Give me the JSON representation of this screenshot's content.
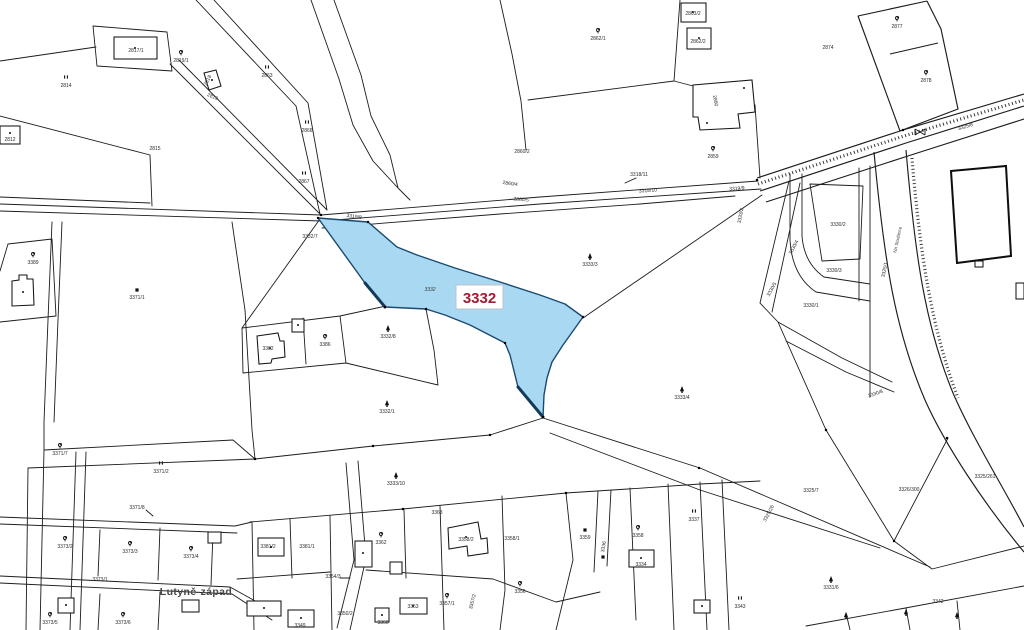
{
  "map": {
    "type": "cadastral-parcel-map",
    "colors": {
      "background": "#ffffff",
      "boundary": "#1c1c1c",
      "highlight_fill": "#a9d8f2",
      "highlight_border": "#1b4a70",
      "highlight_label_text": "#9f1d33",
      "label_text": "#2b2b2b",
      "place_text": "#474747"
    },
    "highlight": {
      "parcel_number": "3332",
      "box_label": "3332",
      "inline_label": "3332"
    },
    "place_name": {
      "text": "Lutyně-západ"
    },
    "parcel_labels": [
      {
        "t": "2817/1",
        "x": 136,
        "y": 52
      },
      {
        "t": "2819/1",
        "x": 181,
        "y": 62,
        "icon": "deciduous"
      },
      {
        "t": "2814",
        "x": 66,
        "y": 87,
        "icon": "meadow"
      },
      {
        "t": "2812",
        "x": 10,
        "y": 141
      },
      {
        "t": "2815",
        "x": 155,
        "y": 150
      },
      {
        "t": "2863",
        "x": 267,
        "y": 77,
        "icon": "meadow"
      },
      {
        "t": "2866",
        "x": 307,
        "y": 132,
        "icon": "meadow"
      },
      {
        "t": "2867",
        "x": 304,
        "y": 183,
        "icon": "meadow"
      },
      {
        "t": "2818",
        "x": 209,
        "y": 81,
        "rot": -62
      },
      {
        "t": "2819",
        "x": 212,
        "y": 98,
        "rot": 24
      },
      {
        "t": "2862/1",
        "x": 598,
        "y": 40,
        "icon": "deciduous"
      },
      {
        "t": "2863/2",
        "x": 693,
        "y": 15
      },
      {
        "t": "2862/2",
        "x": 698,
        "y": 43
      },
      {
        "t": "2860",
        "x": 714,
        "y": 101,
        "rot": 80
      },
      {
        "t": "2860/2",
        "x": 522,
        "y": 153
      },
      {
        "t": "2859",
        "x": 713,
        "y": 158,
        "icon": "deciduous"
      },
      {
        "t": "3318/11",
        "x": 639,
        "y": 176
      },
      {
        "t": "2860/4",
        "x": 510,
        "y": 185,
        "rot": 8
      },
      {
        "t": "2860/5",
        "x": 521,
        "y": 201,
        "rot": 5
      },
      {
        "t": "3318/10",
        "x": 648,
        "y": 192,
        "rot": -4
      },
      {
        "t": "3319/9",
        "x": 737,
        "y": 190,
        "rot": -4
      },
      {
        "t": "2874",
        "x": 828,
        "y": 49
      },
      {
        "t": "2877",
        "x": 897,
        "y": 28,
        "icon": "deciduous"
      },
      {
        "t": "2878",
        "x": 926,
        "y": 82,
        "icon": "deciduous"
      },
      {
        "t": "3325/8",
        "x": 966,
        "y": 128,
        "rot": -17
      },
      {
        "t": "3332/7",
        "x": 310,
        "y": 238
      },
      {
        "t": "3319/8",
        "x": 354,
        "y": 218,
        "rot": 8
      },
      {
        "t": "3333/3",
        "x": 590,
        "y": 266,
        "icon": "conifer"
      },
      {
        "t": "3333/4",
        "x": 682,
        "y": 399,
        "icon": "conifer"
      },
      {
        "t": "3332/8",
        "x": 388,
        "y": 338,
        "icon": "conifer"
      },
      {
        "t": "3332/1",
        "x": 387,
        "y": 413,
        "icon": "conifer"
      },
      {
        "t": "3333/10",
        "x": 396,
        "y": 485,
        "icon": "conifer"
      },
      {
        "t": "3386",
        "x": 325,
        "y": 346,
        "icon": "deciduous"
      },
      {
        "t": "3382",
        "x": 268,
        "y": 350
      },
      {
        "t": "3389",
        "x": 33,
        "y": 264,
        "icon": "deciduous"
      },
      {
        "t": "3371/1",
        "x": 137,
        "y": 299,
        "icon": "building-mark"
      },
      {
        "t": "3371/2",
        "x": 161,
        "y": 473,
        "icon": "meadow"
      },
      {
        "t": "3371/7",
        "x": 60,
        "y": 455,
        "icon": "deciduous"
      },
      {
        "t": "3371/8",
        "x": 137,
        "y": 509
      },
      {
        "t": "3373/2",
        "x": 65,
        "y": 548,
        "icon": "deciduous"
      },
      {
        "t": "3373/3",
        "x": 130,
        "y": 553,
        "icon": "deciduous"
      },
      {
        "t": "3373/4",
        "x": 191,
        "y": 558,
        "icon": "deciduous"
      },
      {
        "t": "3373/1",
        "x": 100,
        "y": 581
      },
      {
        "t": "3373/5",
        "x": 50,
        "y": 624,
        "icon": "deciduous"
      },
      {
        "t": "3373/6",
        "x": 123,
        "y": 624,
        "icon": "deciduous"
      },
      {
        "t": "3381/2",
        "x": 268,
        "y": 548
      },
      {
        "t": "3381/1",
        "x": 307,
        "y": 548
      },
      {
        "t": "3362",
        "x": 381,
        "y": 544,
        "icon": "deciduous"
      },
      {
        "t": "3363",
        "x": 437,
        "y": 514
      },
      {
        "t": "3358/2",
        "x": 466,
        "y": 541
      },
      {
        "t": "3358/1",
        "x": 512,
        "y": 540
      },
      {
        "t": "3354/3",
        "x": 333,
        "y": 578
      },
      {
        "t": "3350/2",
        "x": 345,
        "y": 615
      },
      {
        "t": "3349",
        "x": 300,
        "y": 627
      },
      {
        "t": "3360",
        "x": 383,
        "y": 624
      },
      {
        "t": "3353",
        "x": 413,
        "y": 608
      },
      {
        "t": "3357/1",
        "x": 447,
        "y": 605,
        "icon": "deciduous"
      },
      {
        "t": "3357/2",
        "x": 474,
        "y": 602,
        "rot": -75
      },
      {
        "t": "3356",
        "x": 520,
        "y": 593,
        "icon": "deciduous"
      },
      {
        "t": "3359",
        "x": 585,
        "y": 539,
        "icon": "building-mark"
      },
      {
        "t": "3336",
        "x": 605,
        "y": 547,
        "rot": -80
      },
      {
        "t": "3358",
        "x": 638,
        "y": 537,
        "icon": "deciduous"
      },
      {
        "t": "3337",
        "x": 694,
        "y": 521,
        "icon": "meadow"
      },
      {
        "t": "3334",
        "x": 641,
        "y": 566
      },
      {
        "t": "3343",
        "x": 740,
        "y": 608,
        "icon": "meadow"
      },
      {
        "t": "3325/26",
        "x": 770,
        "y": 514,
        "rot": -62
      },
      {
        "t": "3325/7",
        "x": 811,
        "y": 492
      },
      {
        "t": "3326/300",
        "x": 909,
        "y": 491
      },
      {
        "t": "3325/261",
        "x": 985,
        "y": 478
      },
      {
        "t": "3331/6",
        "x": 831,
        "y": 589,
        "icon": "conifer"
      },
      {
        "t": "3342",
        "x": 938,
        "y": 603
      },
      {
        "t": "3330/2",
        "x": 838,
        "y": 226
      },
      {
        "t": "3330/3",
        "x": 834,
        "y": 272
      },
      {
        "t": "3330/1",
        "x": 811,
        "y": 307
      },
      {
        "t": "3330/8",
        "x": 876,
        "y": 395,
        "rot": -20
      },
      {
        "t": "3330/4",
        "x": 795,
        "y": 248,
        "rot": -62
      },
      {
        "t": "3330/5",
        "x": 773,
        "y": 290,
        "rot": -62
      },
      {
        "t": "3333/2",
        "x": 742,
        "y": 216,
        "rot": -80
      },
      {
        "t": "3325/1",
        "x": 886,
        "y": 270,
        "rot": -78
      },
      {
        "t": "Na Studánce",
        "x": 899,
        "y": 240,
        "rot": -78,
        "cls": "street"
      }
    ],
    "extra_icons": [
      {
        "type": "conifer",
        "x": 846,
        "y": 616
      },
      {
        "type": "conifer",
        "x": 906,
        "y": 613
      },
      {
        "type": "conifer",
        "x": 957,
        "y": 616
      },
      {
        "type": "building-mark",
        "x": 603,
        "y": 557
      },
      {
        "type": "culvert",
        "x": 920,
        "y": 132
      }
    ]
  }
}
